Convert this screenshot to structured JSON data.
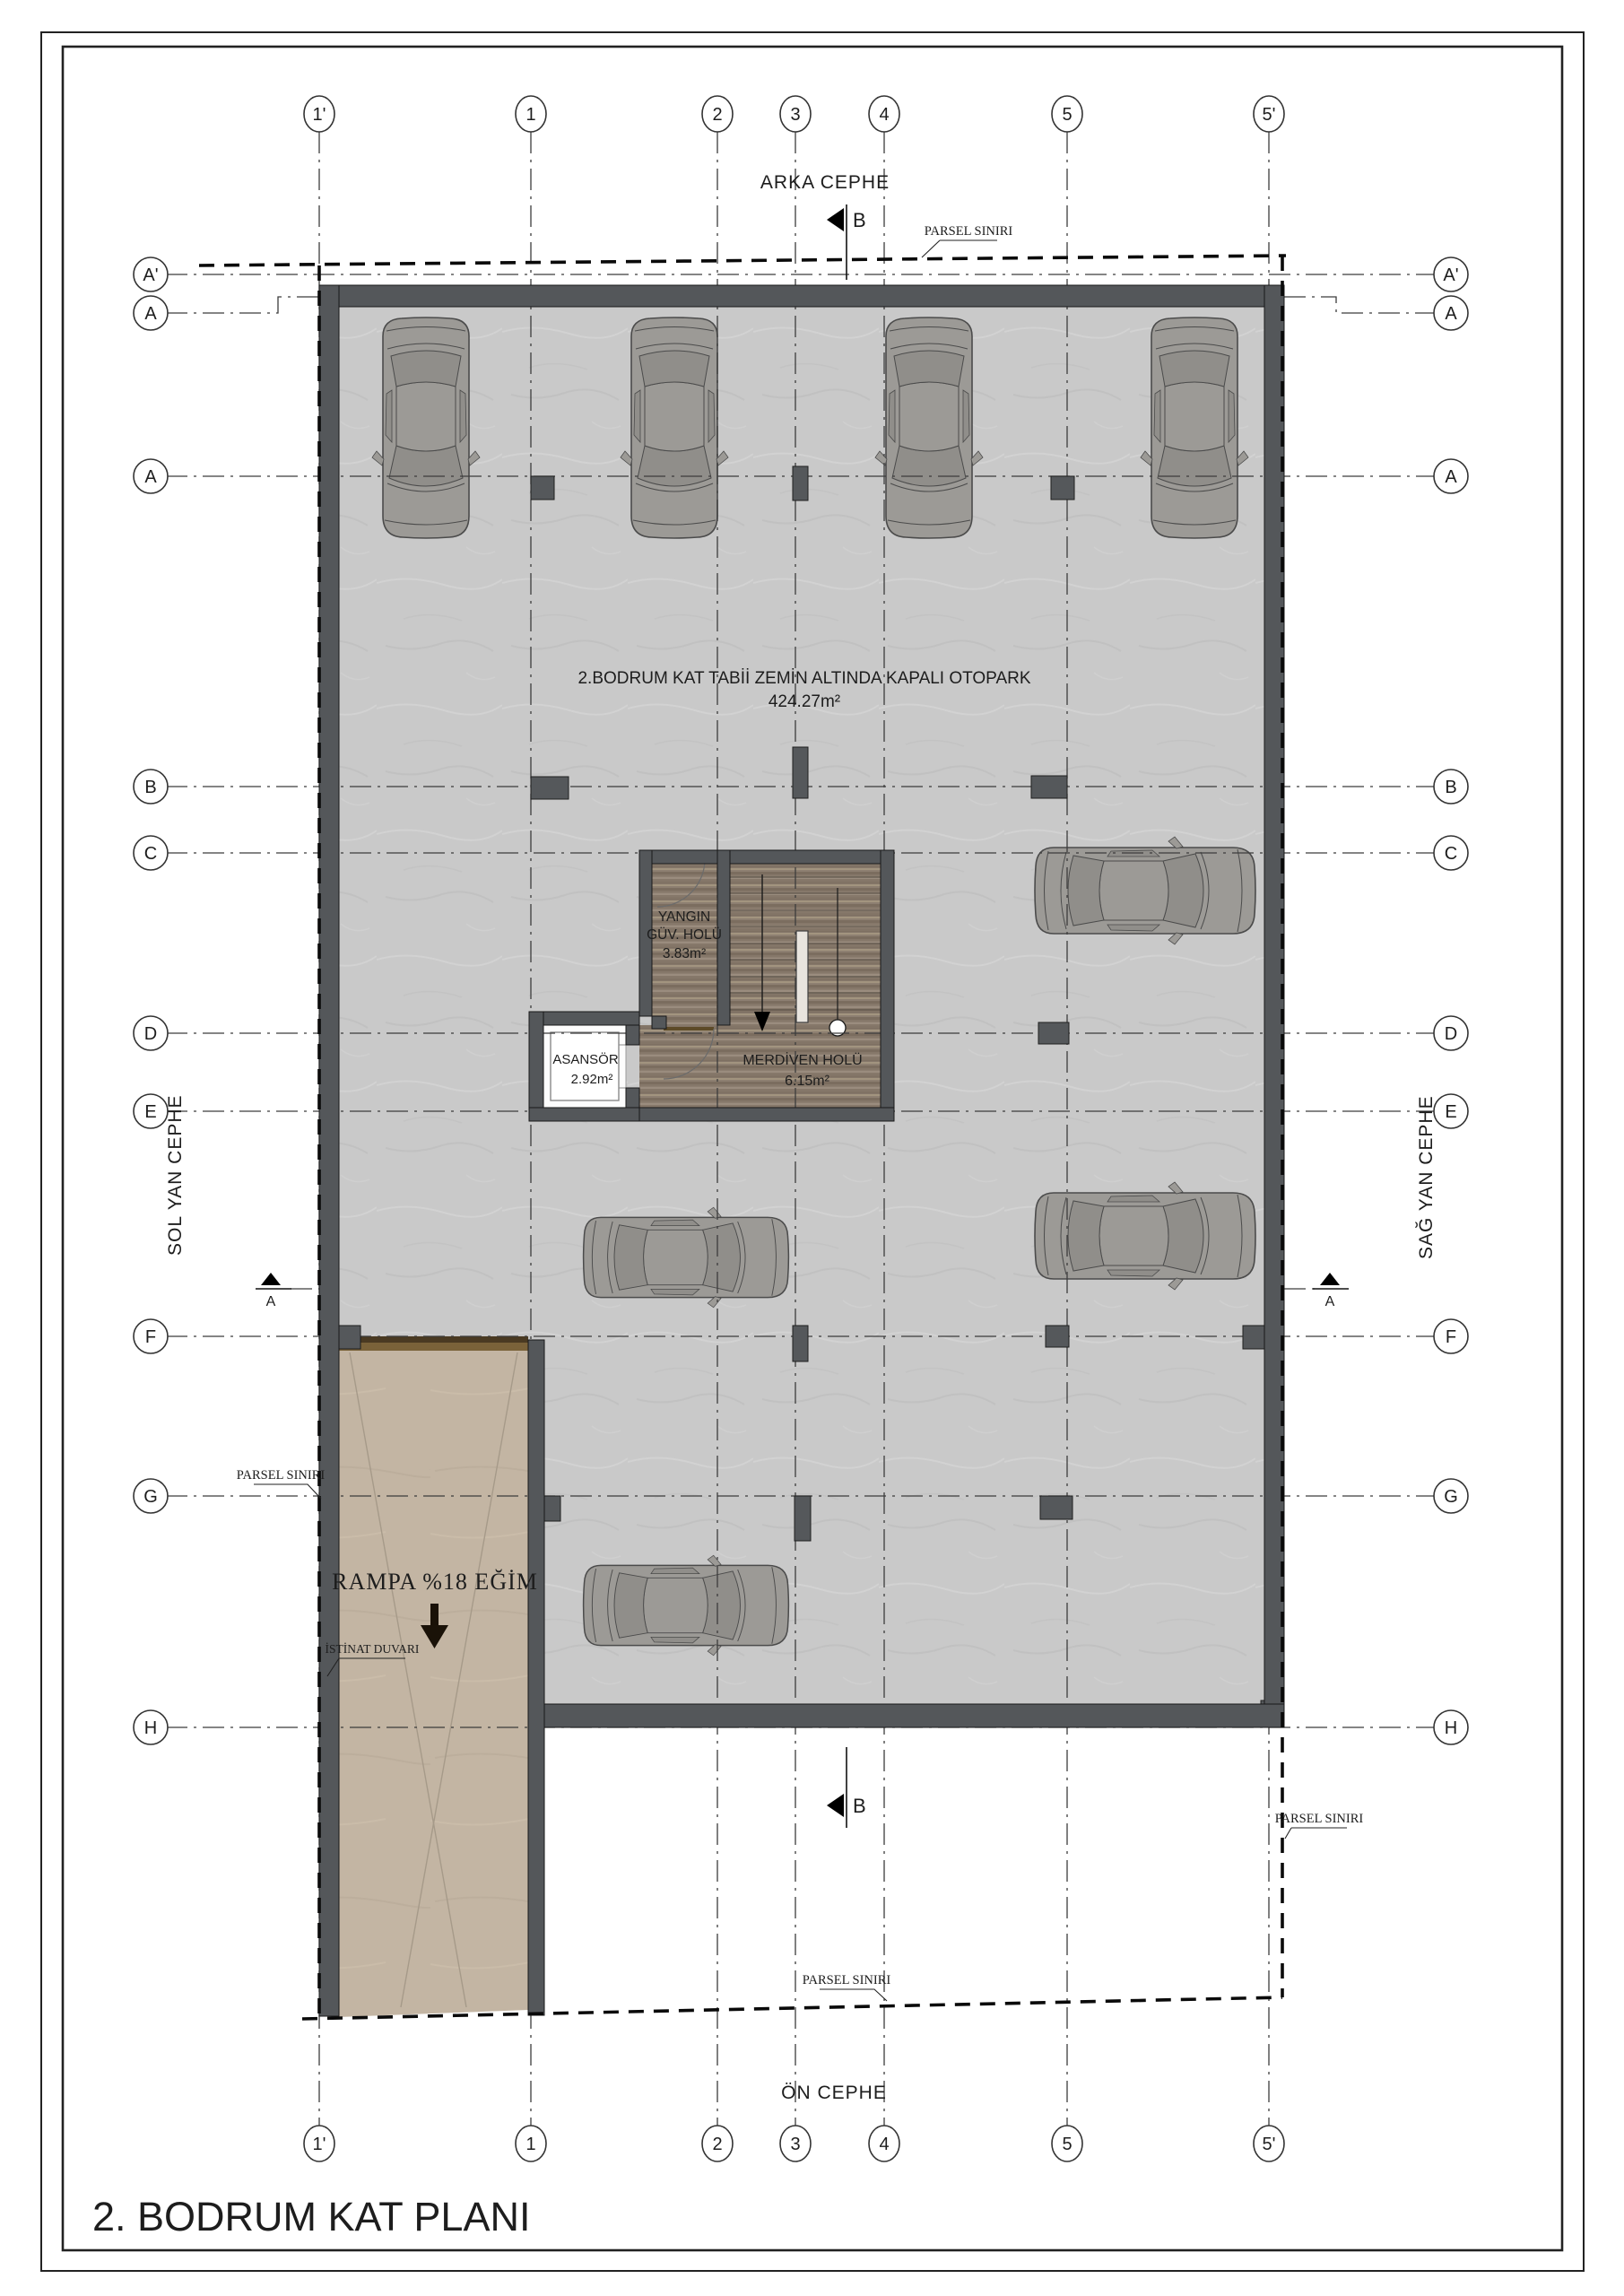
{
  "page": {
    "title": "2. BODRUM KAT PLANI"
  },
  "facades": {
    "back": "ARKA CEPHE",
    "front": "ÖN CEPHE",
    "left": "SOL YAN CEPHE",
    "right": "SAĞ YAN CEPHE"
  },
  "grid": {
    "cols": [
      "1'",
      "1",
      "2",
      "3",
      "4",
      "5",
      "5'"
    ],
    "rows": [
      "A'",
      "A",
      "A",
      "B",
      "C",
      "D",
      "E",
      "F",
      "G",
      "H"
    ]
  },
  "sections": {
    "a": "A",
    "b": "B"
  },
  "otopark": {
    "title": "2.BODRUM KAT TABİİ ZEMİN ALTINDA KAPALI OTOPARK",
    "area": "424.27m²"
  },
  "rooms": {
    "yangin_l1": "YANGIN",
    "yangin_l2": "GÜV. HOLÜ",
    "yangin_area": "3.83m²",
    "asansor": "ASANSÖR",
    "asansor_area": "2.92m²",
    "merdiven": "MERDİVEN HOLÜ",
    "merdiven_area": "6.15m²"
  },
  "ramp": {
    "label": "RAMPA %18 EĞİM"
  },
  "labels": {
    "parsel": "PARSEL SINIRI",
    "istinat": "İSTİNAT DUVARI"
  },
  "colors": {
    "wall": "#54575a",
    "floor": "#c9c9c9",
    "wood": "#8d7f71",
    "ramp": "#c3b5a3",
    "ramp_band": "#5a4628",
    "car": "#9c9a96"
  }
}
